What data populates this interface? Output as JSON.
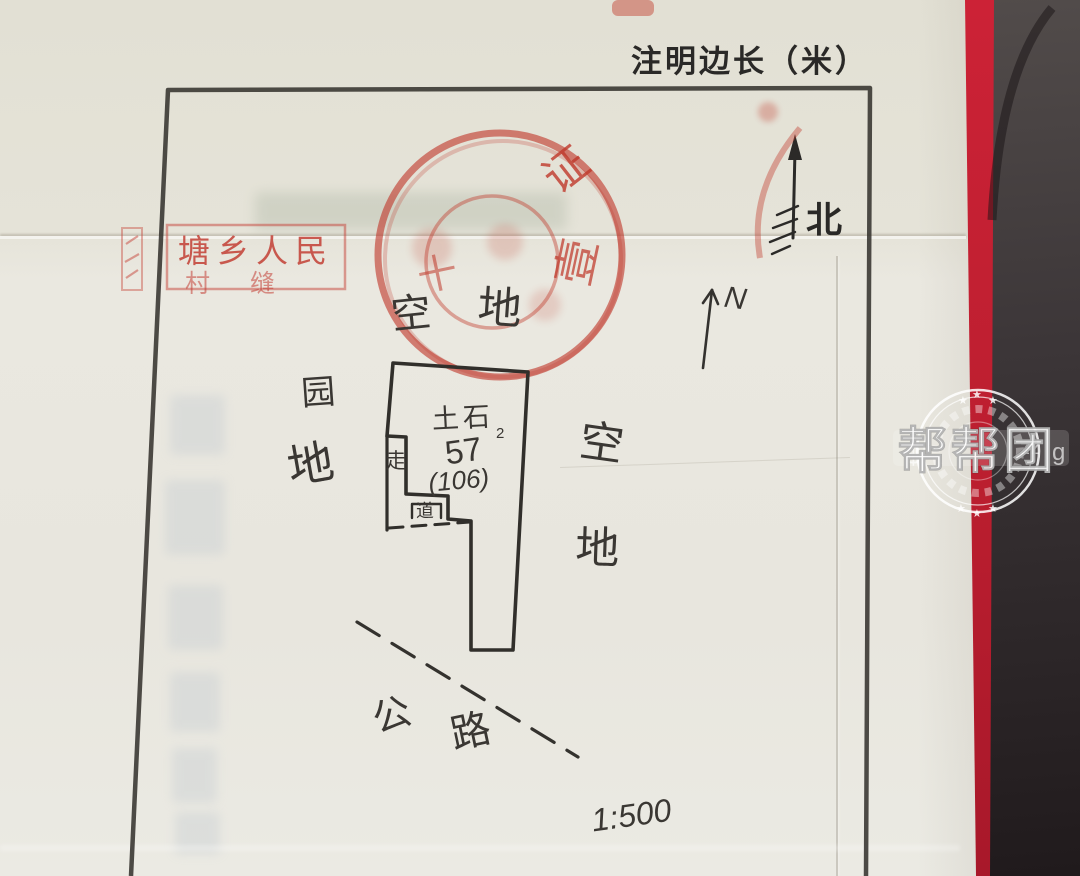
{
  "header": {
    "instruction": "注明边长（米）"
  },
  "compass": {
    "printed": "北",
    "hand": "N"
  },
  "stamps": {
    "round": {
      "char1": "证",
      "char2": "壹",
      "char3": "十"
    },
    "rect": {
      "line1": "塘乡人民",
      "line2": "村缝"
    }
  },
  "plot": {
    "area_top": {
      "c1": "空",
      "c2": "地"
    },
    "area_left": {
      "c1": "园",
      "c2": "地"
    },
    "area_right": {
      "c1": "空",
      "c2": "地"
    },
    "road": {
      "c1": "公",
      "c2": "路"
    },
    "building": {
      "material": "土石",
      "material_sub": "2",
      "value": "57",
      "value_paren": "(106)",
      "walk": "走",
      "path": "道"
    },
    "scale": "1:500"
  },
  "watermark": {
    "brand": "帮帮团",
    "frag1": "$",
    "frag2": "zz",
    "frag3": "g"
  },
  "colors": {
    "stamp_red": "#c0392b",
    "spine_red": "#c32034",
    "ink": "#38352f",
    "paper": "#e7e5dd"
  }
}
